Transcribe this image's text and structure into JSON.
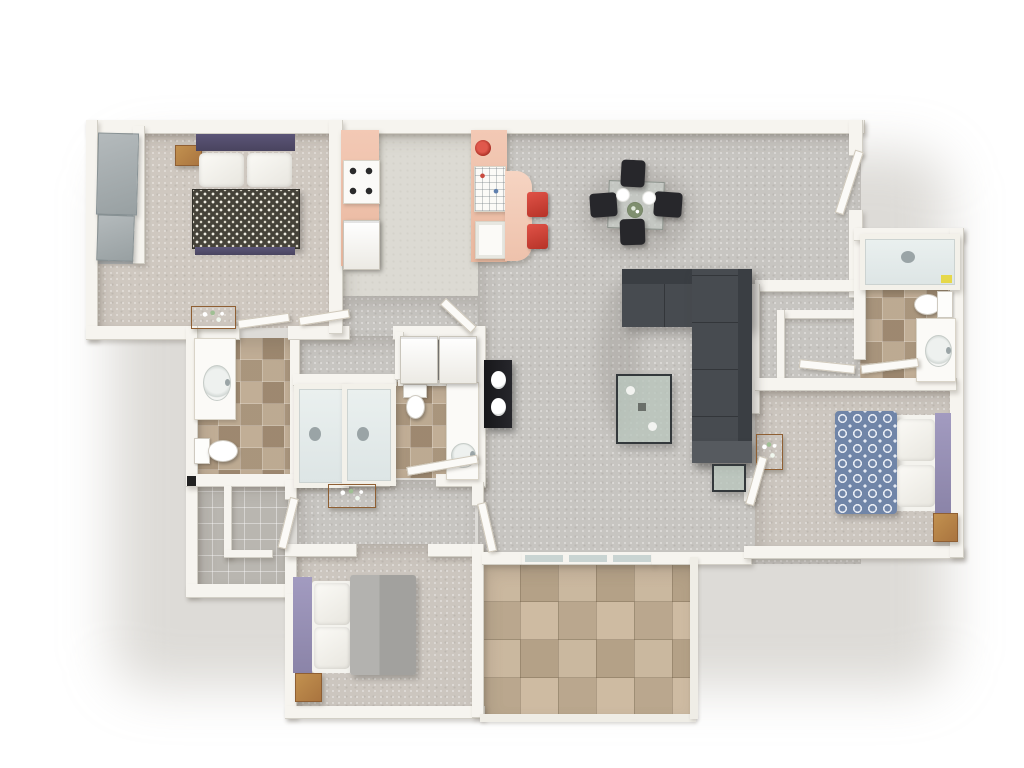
{
  "scene": {
    "type": "3d-floor-plan-top-down-render",
    "description": "3D rendered top-down floor plan of a three-bedroom, two-and-a-half-bath apartment with open kitchen, dining and living areas and a tiled patio",
    "background": "#ffffff"
  },
  "palette": {
    "bg": "#ffffff",
    "wall": "#f6f4ef",
    "white-soft": "#fbfaf7",
    "carpet-a": "#c7c5c1",
    "carpet-b": "#cfc8c0",
    "carpet-c": "#ccc6bf",
    "kitchen-floor": "#dcdad3",
    "tile-light": "#b3a189",
    "patio-base": "#c3b097",
    "closet-floor": "#b9b6b0",
    "laundry-floor": "#8c8b89",
    "counter-salmon": "#eec2ad",
    "accent-red": "#d0453c",
    "chair-black": "#27272b",
    "sofa": "#474b50",
    "sofa-dark": "#3a3e43",
    "glass-green": "#b9c3bc",
    "wood": "#b5834e",
    "bed1-headboard": "#534e6b",
    "bed1-duvet": "#454239",
    "bed2-duvet": "#7085a8",
    "bed2-headboard": "#968fb4",
    "bed3-duvet": "#a5a4a1",
    "tub-inner": "#e4eaea",
    "towel-yellow": "#e6d84a"
  },
  "rooms": [
    {
      "id": "bedroom-1",
      "label": "bedroom upper-left with closet"
    },
    {
      "id": "kitchen",
      "label": "kitchen with breakfast bar"
    },
    {
      "id": "dining-area",
      "label": "dining area"
    },
    {
      "id": "living-room",
      "label": "living room"
    },
    {
      "id": "bathroom-1",
      "label": "left bathroom with tub"
    },
    {
      "id": "bathroom-2",
      "label": "center bathroom with tub"
    },
    {
      "id": "laundry-closet",
      "label": "laundry closet with washer and dryer"
    },
    {
      "id": "walk-in-closet",
      "label": "walk-in closet lower-left"
    },
    {
      "id": "bedroom-3",
      "label": "bedroom bottom"
    },
    {
      "id": "patio",
      "label": "tiled patio"
    },
    {
      "id": "bedroom-2",
      "label": "bedroom right"
    },
    {
      "id": "bathroom-3",
      "label": "en-suite bathroom upper-right"
    },
    {
      "id": "hall-closet",
      "label": "hallway closet right of living room"
    },
    {
      "id": "entry",
      "label": "entry door upper-right"
    }
  ],
  "furniture": [
    {
      "id": "bed-1",
      "label": "double bed, navy headboard, patterned spread"
    },
    {
      "id": "bed-2",
      "label": "double bed, blue circle-pattern duvet"
    },
    {
      "id": "bed-3",
      "label": "double bed, gray duvet"
    },
    {
      "id": "sectional-sofa",
      "label": "dark gray L-shaped sectional"
    },
    {
      "id": "coffee-table",
      "label": "glass coffee table"
    },
    {
      "id": "side-table",
      "label": "glass side table"
    },
    {
      "id": "tv-console",
      "label": "black media console"
    },
    {
      "id": "dining-set",
      "label": "glass table, four black chairs, two plates, plant"
    },
    {
      "id": "bar-stools",
      "label": "two red bar stools"
    },
    {
      "id": "stove",
      "label": "four-burner stove"
    },
    {
      "id": "island-sink",
      "label": "island with sink and dish rack"
    },
    {
      "id": "washer-dryer",
      "label": "washer and dryer pair"
    },
    {
      "id": "bathtubs",
      "label": "three bathtubs"
    },
    {
      "id": "toilets",
      "label": "three toilets"
    },
    {
      "id": "vanities",
      "label": "three vanity sinks"
    },
    {
      "id": "nightstands",
      "label": "wood nightstands"
    },
    {
      "id": "flower-consoles",
      "label": "wood console tables with flowers"
    }
  ]
}
